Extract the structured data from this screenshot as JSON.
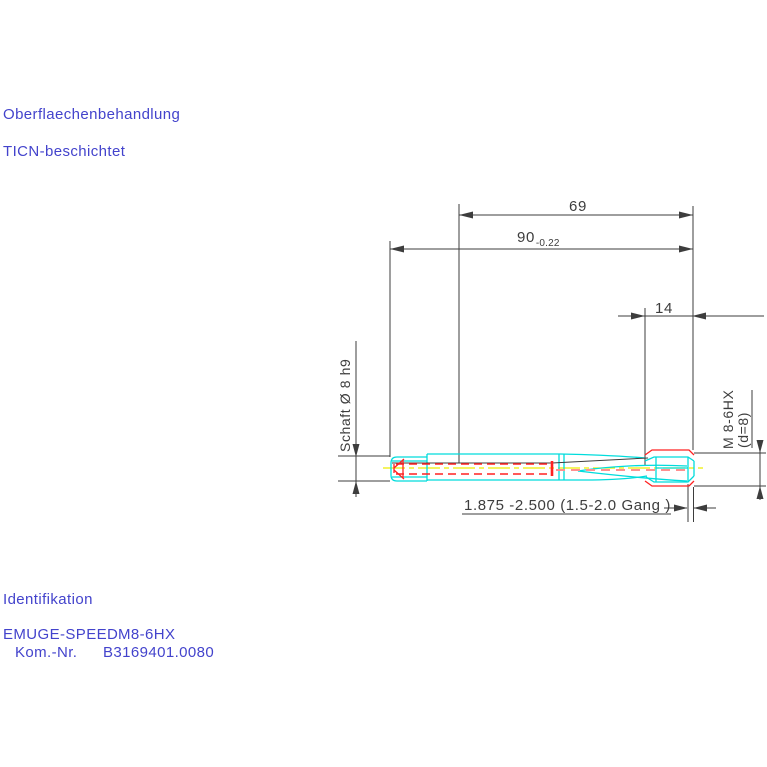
{
  "colors": {
    "background": "#ffffff",
    "blue": "#4343cc",
    "dim": "#3d3d3d",
    "cyan": "#00dcdc",
    "red": "#ff2222",
    "salmon": "#ff9090",
    "yellow": "#eeee00"
  },
  "annotations": {
    "surface_treatment_title": "Oberflaechenbehandlung",
    "surface_treatment_value": "TICN-beschichtet",
    "identification_title": "Identifikation",
    "product_name": "EMUGE-SPEED",
    "product_size": "M8-6HX",
    "kom_label": "Kom.-Nr.",
    "kom_number": "B3169401.0080"
  },
  "dimensions": {
    "overall_length": "90",
    "overall_length_tolerance": "-0.22",
    "flute_length": "69",
    "thread_length": "14",
    "shank_label": "Schaft Ø 8 h9",
    "thread_label_line1": "M 8-6HX",
    "thread_label_line2": "(d=8)",
    "chamfer_note": "1.875 -2.500 (1.5-2.0 Gang )"
  }
}
